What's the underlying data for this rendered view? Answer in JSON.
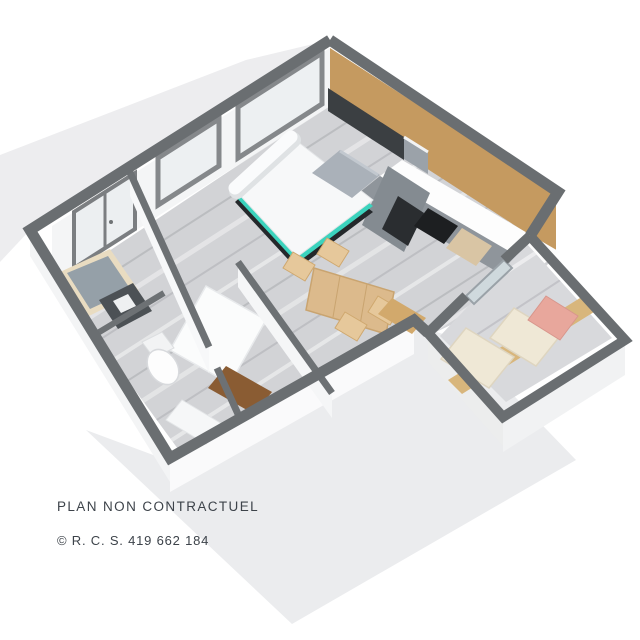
{
  "figure": {
    "kind": "isometric-3d-floor-plan",
    "rooms": [
      "living-room",
      "kitchen",
      "entry-hall",
      "wc",
      "bathroom",
      "balcony"
    ],
    "furniture": [
      "double-bed",
      "dining-table",
      "dining-chairs",
      "kitchen-counter",
      "tall-cabinet",
      "wardrobe",
      "entry-bench",
      "toilet",
      "shower-unit",
      "wash-tray",
      "balcony-daybed",
      "pink-cushion"
    ],
    "colors": {
      "wall_cap": "#6a6e71",
      "floor": "#d2d3d6",
      "wood_wall": "#c59a60",
      "accent_teal": "#3bd3bd",
      "table_wood": "#dcba8c",
      "chair_wood": "#e6c89b",
      "cushion_pink": "#e8a79c",
      "cushion_cream": "#efe8d6",
      "counter_white": "#fdfdfd",
      "cabinet_gray": "#8f959b",
      "vanity_brown": "#8a5c33",
      "backdrop_gray": "#ededef"
    }
  },
  "footer": {
    "disclaimer": "PLAN NON CONTRACTUEL",
    "registration": "© R. C. S. 419 662 184"
  }
}
